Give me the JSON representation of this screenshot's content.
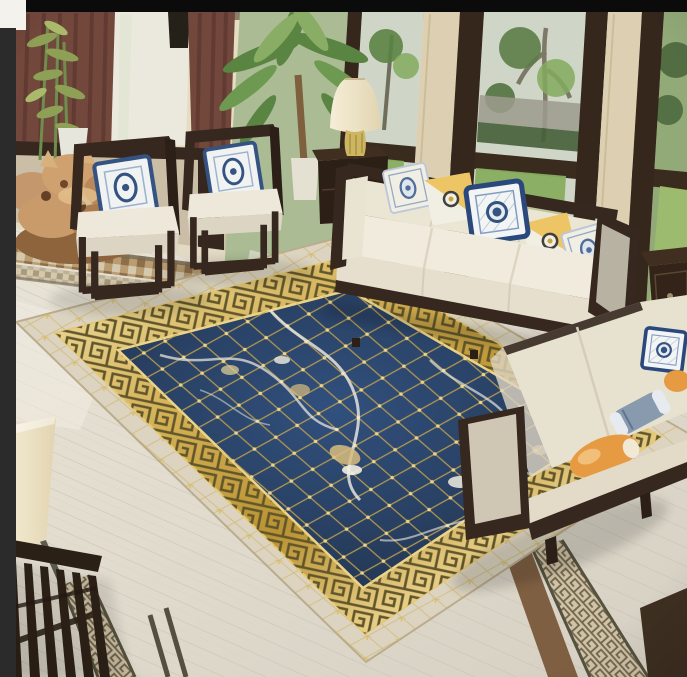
{
  "meta": {
    "title": "Living room photo: navy blue and gold Greek-key area rug on a white marble floor, styled with dark-wood framed white sofas, two open-frame wooden armchairs with blue-and-white porcelain pillows, a table lamp, a potted palm and tall garden windows.",
    "width": 687,
    "height": 677
  },
  "frame": {
    "top_bar_color": "#0b0b0b",
    "side_strip_color": "#2b2b2b",
    "corner_color": "#f4f2ed"
  },
  "palette": {
    "espresso": "#2f2019",
    "wood_dark": "#241712",
    "wood_mid": "#4a352a",
    "navy": "#20375a",
    "navy_deep": "#172b47",
    "gold": "#c9a33a",
    "gold_light": "#f2e2a8",
    "gold_mid": "#d4af52",
    "gold_dark": "#8f6d22",
    "greek_ink": "#5c5126",
    "cream_sofa": "#efe9dc",
    "cream_shadow": "#ddd5c5",
    "gray_panel": "#b7b0a3",
    "wall": "#e7dcc2",
    "pillar": "#ddd0b2",
    "wall_shade": "#c9bda6",
    "floor_light": "#e8e3d8",
    "floor_mid": "#d8d2c6",
    "plank": "#c6bfb0",
    "maroon": "#6e4138",
    "maroon_dark": "#4e2b25",
    "leaf": "#55803e",
    "leaf_light": "#7fa85c",
    "lawn": "#85ab5c",
    "glass": "#cfd6c8",
    "fence": "#9a998c",
    "hedge": "#3f5c34",
    "tan": "#c3946a",
    "tan_dark": "#96643c",
    "trunk": "#7a5a3a",
    "porcelain_blue": "#2e4e80",
    "porcelain_light": "#9ab0cc",
    "pillow_yellow": "#eec15a",
    "orange": "#e6983f",
    "blue_gray": "#8598ae",
    "frame_black": "#0b0b0b",
    "frame_strip": "#2b2b2b",
    "frame_corner": "#f4f2ed",
    "mosaic_tan": "#b89a6e",
    "mosaic_brown": "#8a6a46",
    "mosaic_pale": "#d4c8af",
    "strip_tan": "#cfc3a8",
    "strip_ink": "#6e5f48",
    "vein": "#f3efe4",
    "shade_cream": "#f0e5cb"
  },
  "scene": {
    "objects": [
      {
        "name": "area-rug",
        "desc": "navy center with gold diamond lattice and white-gold marble veining, gold Greek-key meander border, cream marble outer band with gold lattice"
      },
      {
        "name": "main-sofa",
        "desc": "three-seat white fabric sofa, dark espresso wood frame",
        "pillow_count": 5
      },
      {
        "name": "second-sofa",
        "desc": "two-seat sofa viewed from behind with orange and blue-gray bolster pillows"
      },
      {
        "name": "armchair-left",
        "desc": "open-cube dark wood armchair, white cushion, blue-white porcelain pillow"
      },
      {
        "name": "armchair-right",
        "desc": "open-cube dark wood armchair, white cushion, blue-white porcelain pillow"
      },
      {
        "name": "table-lamp",
        "desc": "cream bell shade, gold ceramic base"
      },
      {
        "name": "lamp-side-cabinet",
        "desc": "dark wood cabinet between armchairs and sofa"
      },
      {
        "name": "right-side-table",
        "desc": "dark wood side table with drawer and knob"
      },
      {
        "name": "potted-palm",
        "desc": "tall palm in white planter"
      },
      {
        "name": "bamboo-plant",
        "desc": "bamboo in white planter by the window"
      },
      {
        "name": "root-carving",
        "desc": "tan natural root-wood sculpture on the floor"
      },
      {
        "name": "window-wall",
        "desc": "floor-to-ceiling windows, dark frames, garden with trees and lawn outside"
      },
      {
        "name": "curtains",
        "desc": "two maroon drape panels"
      },
      {
        "name": "marble-floor",
        "desc": "light marble plank floor with inlaid mosaic and Greek-key border strips"
      },
      {
        "name": "foreground-lamp",
        "desc": "cream lamp shade in lower-left foreground"
      },
      {
        "name": "foreground-chair",
        "desc": "dark slatted wood chair back in lower-left foreground"
      }
    ]
  }
}
